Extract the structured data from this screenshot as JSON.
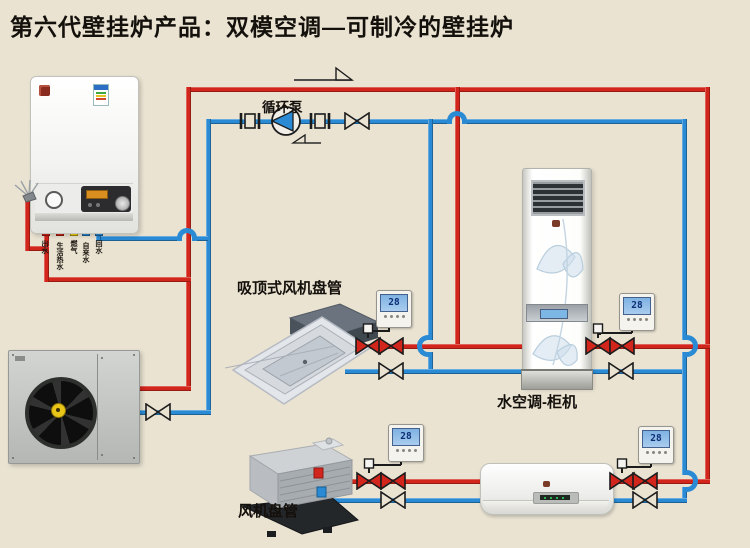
{
  "title": "第六代壁挂炉产品：双模空调—可制冷的壁挂炉",
  "labels": {
    "pump": "循环泵",
    "ceiling_cassette": "吸顶式风机盘管",
    "cabinet_unit": "水空调-柜机",
    "fan_coil": "风机盘管"
  },
  "boiler": {
    "ports": [
      {
        "name": "heating-supply",
        "label": "出水",
        "color": "#d2251b"
      },
      {
        "name": "dhw",
        "label": "生活热水",
        "color": "#d2251b"
      },
      {
        "name": "gas",
        "label": "燃气",
        "color": "#f2d212"
      },
      {
        "name": "tap-water",
        "label": "自来水",
        "color": "#2a8bd4"
      },
      {
        "name": "return",
        "label": "回水",
        "color": "#2a8bd4"
      }
    ]
  },
  "thermostats": [
    {
      "location": "ceiling-cassette",
      "value": "28"
    },
    {
      "location": "cabinet",
      "value": "28"
    },
    {
      "location": "fan-coil",
      "value": "28"
    },
    {
      "location": "wall-ac",
      "value": "28"
    }
  ],
  "colors": {
    "background": "#eae3d2",
    "hot_pipe": "#d2251b",
    "cold_pipe": "#2a8bd4",
    "wire": "#1c1c1c"
  }
}
